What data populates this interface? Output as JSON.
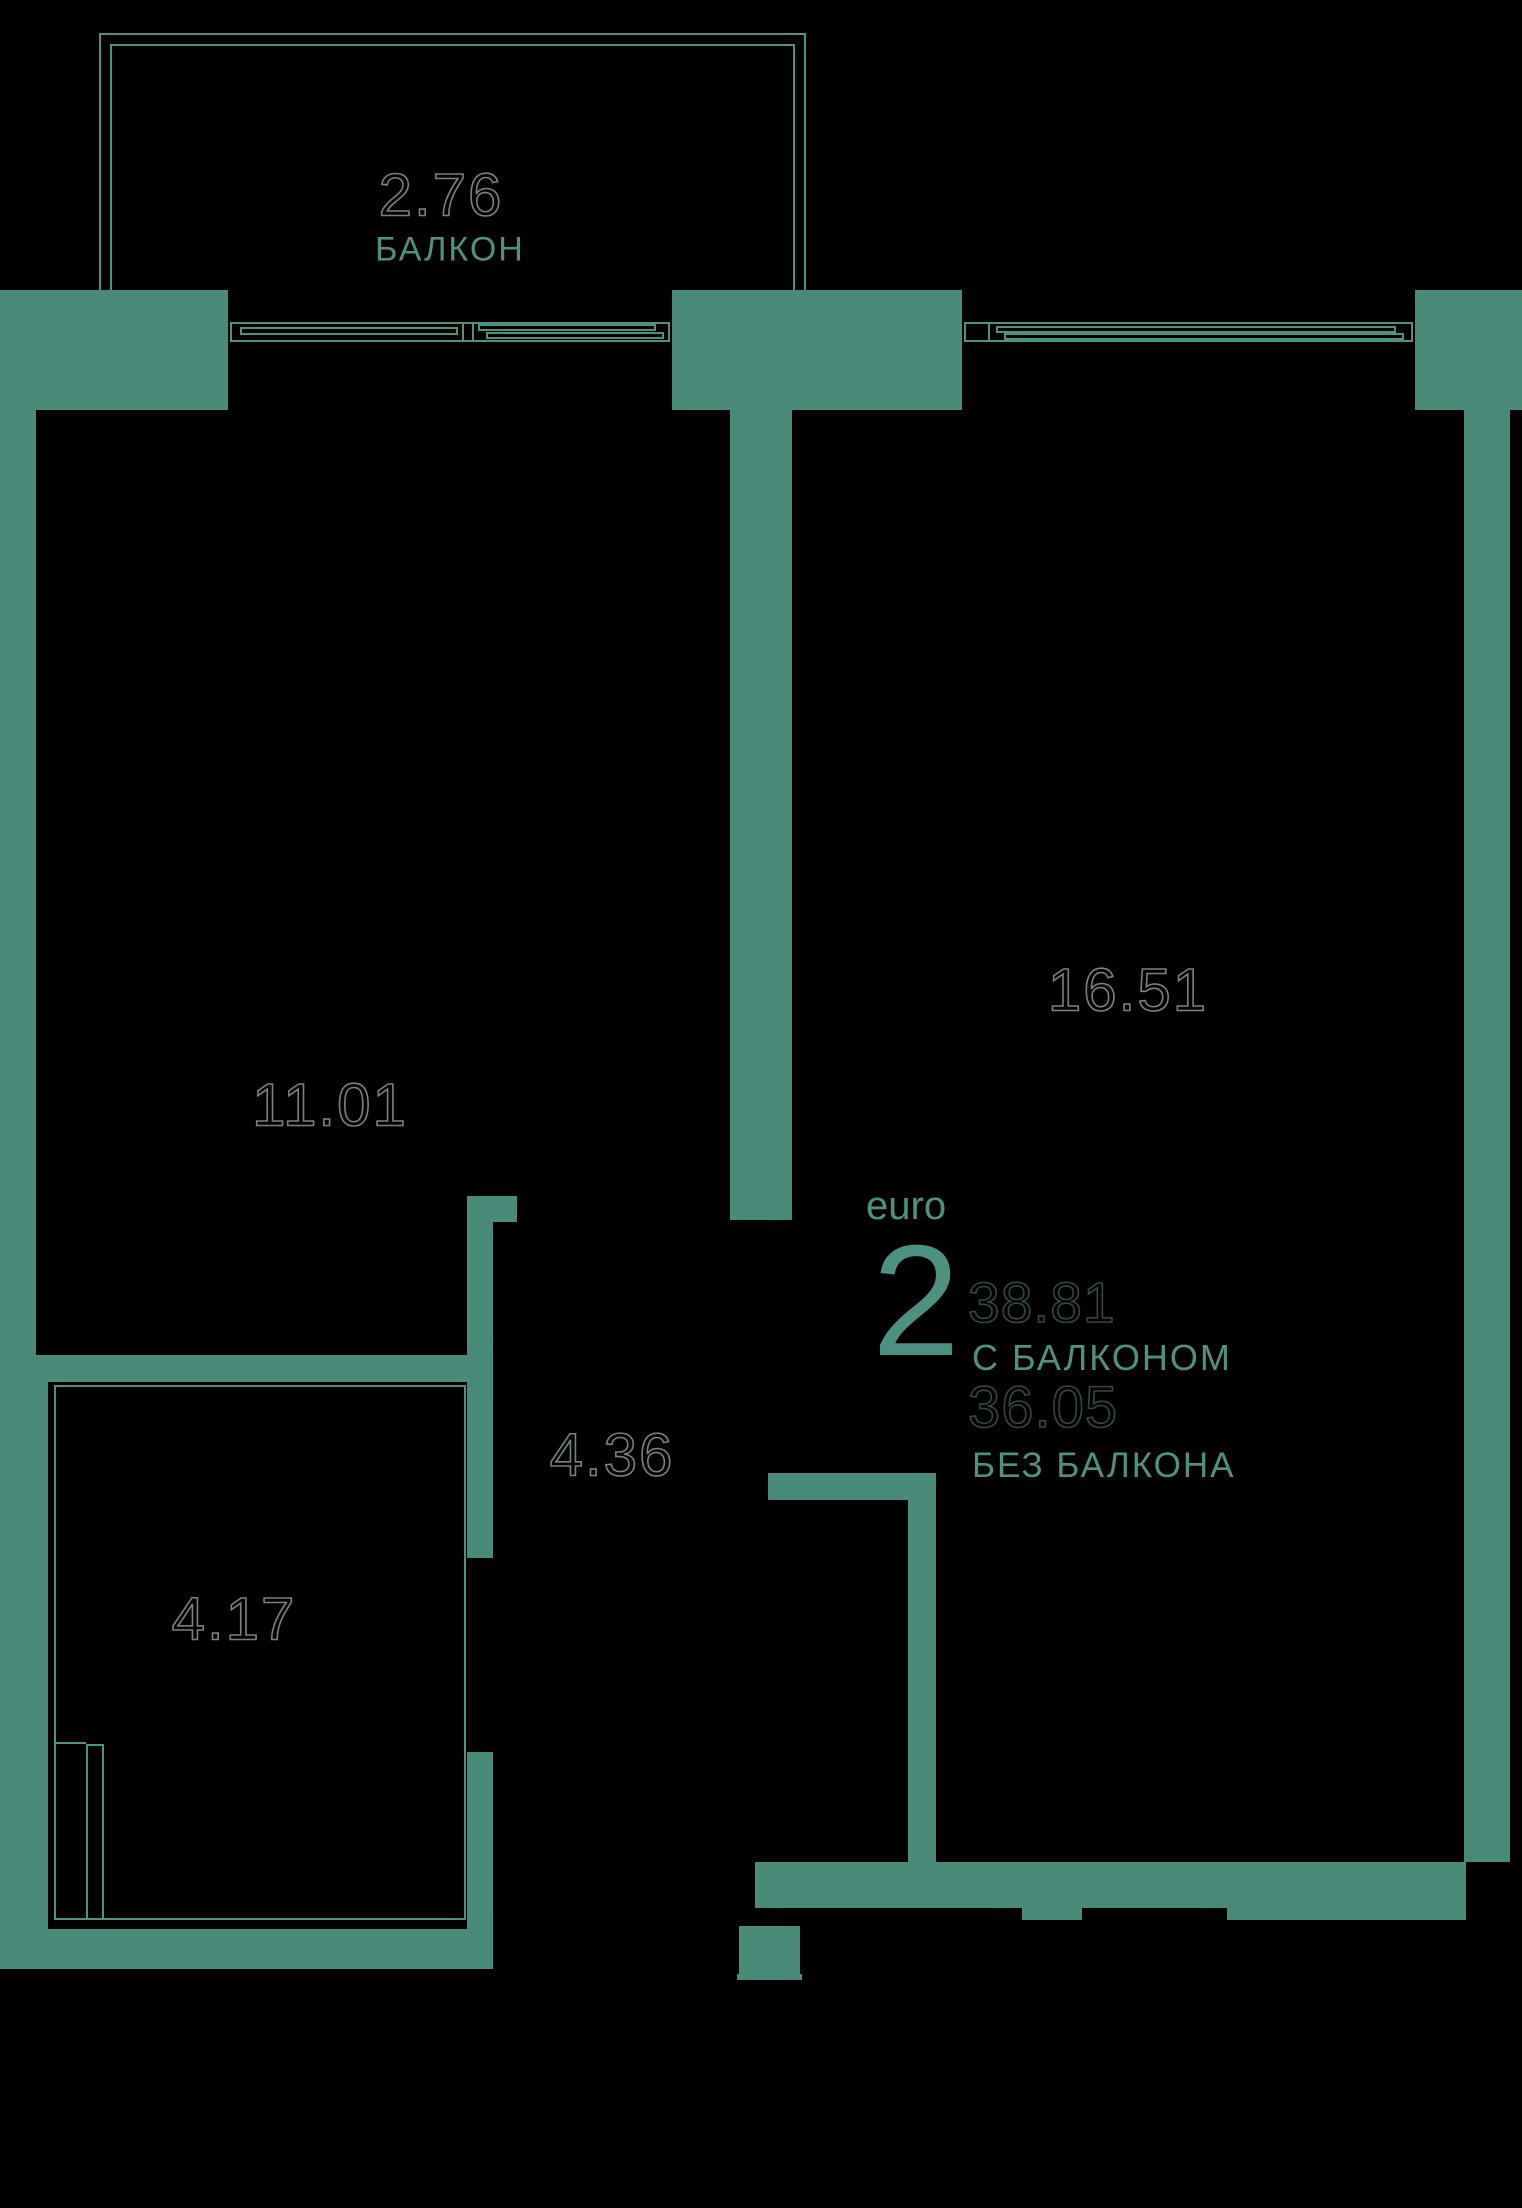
{
  "palette": {
    "background": "#000000",
    "wall": "#4a8a79",
    "line": "#4d9180",
    "teal_text": "#4d9180",
    "number_outline": "#77837d",
    "number_outline_dark": "#2f4a42"
  },
  "labels": {
    "balcony_area": "2.76",
    "balcony_name": "БАЛКОН",
    "room1_area": "11.01",
    "room2_area": "16.51",
    "corridor_area": "4.36",
    "bathroom_area": "4.17"
  },
  "info": {
    "type_label": "euro",
    "rooms_count": "2",
    "area_with_balcony": "38.81",
    "with_balcony_label": "С БАЛКОНОМ",
    "area_without_balcony": "36.05",
    "without_balcony_label": "БЕЗ БАЛКОНА"
  },
  "floorplan": {
    "walls": [
      {
        "name": "wall-top-left",
        "x": 0,
        "y": 290,
        "w": 228,
        "h": 120
      },
      {
        "name": "wall-top-middle",
        "x": 672,
        "y": 290,
        "w": 290,
        "h": 120
      },
      {
        "name": "wall-top-right",
        "x": 1415,
        "y": 290,
        "w": 107,
        "h": 120
      },
      {
        "name": "wall-left-upper",
        "x": 0,
        "y": 410,
        "w": 36,
        "h": 945
      },
      {
        "name": "wall-room-divider",
        "x": 730,
        "y": 410,
        "w": 62,
        "h": 810
      },
      {
        "name": "wall-room1-bathroom",
        "x": 0,
        "y": 1355,
        "w": 471,
        "h": 27
      },
      {
        "name": "wall-corridor-stub",
        "x": 467,
        "y": 1196,
        "w": 50,
        "h": 26
      },
      {
        "name": "wall-corridor-upper",
        "x": 467,
        "y": 1222,
        "w": 26,
        "h": 336
      },
      {
        "name": "wall-corridor-lower",
        "x": 467,
        "y": 1752,
        "w": 26,
        "h": 177
      },
      {
        "name": "wall-left-lower",
        "x": 0,
        "y": 1382,
        "w": 48,
        "h": 547
      },
      {
        "name": "wall-bottom-left",
        "x": 0,
        "y": 1929,
        "w": 493,
        "h": 40
      },
      {
        "name": "wall-hall-corner-h",
        "x": 768,
        "y": 1473,
        "w": 168,
        "h": 27
      },
      {
        "name": "wall-hall-corner-v",
        "x": 908,
        "y": 1500,
        "w": 28,
        "h": 362
      },
      {
        "name": "wall-entry-jamb",
        "x": 739,
        "y": 1926,
        "w": 61,
        "h": 54
      },
      {
        "name": "wall-entry-lip",
        "x": 737,
        "y": 1974,
        "w": 65,
        "h": 6
      },
      {
        "name": "wall-room2-bottom",
        "x": 755,
        "y": 1862,
        "w": 711,
        "h": 46
      },
      {
        "name": "wall-room2-bottom-step-left",
        "x": 1022,
        "y": 1908,
        "w": 60,
        "h": 12
      },
      {
        "name": "wall-room2-bottom-step-right",
        "x": 1227,
        "y": 1908,
        "w": 239,
        "h": 12
      },
      {
        "name": "wall-right",
        "x": 1464,
        "y": 410,
        "w": 46,
        "h": 1452
      }
    ],
    "lines": [
      {
        "name": "balcony-outer-left",
        "x": 99,
        "y": 33,
        "w": 2,
        "h": 257
      },
      {
        "name": "balcony-outer-top",
        "x": 99,
        "y": 33,
        "w": 707,
        "h": 2
      },
      {
        "name": "balcony-outer-right",
        "x": 804,
        "y": 33,
        "w": 2,
        "h": 257
      },
      {
        "name": "balcony-inner-left",
        "x": 110,
        "y": 44,
        "w": 2,
        "h": 246
      },
      {
        "name": "balcony-inner-top",
        "x": 110,
        "y": 44,
        "w": 685,
        "h": 2
      },
      {
        "name": "balcony-inner-right",
        "x": 793,
        "y": 44,
        "w": 2,
        "h": 246
      },
      {
        "name": "window1-frame-top",
        "x": 230,
        "y": 322,
        "w": 440,
        "h": 2
      },
      {
        "name": "window1-frame-bottom",
        "x": 230,
        "y": 340,
        "w": 440,
        "h": 2
      },
      {
        "name": "window1-frame-left",
        "x": 230,
        "y": 322,
        "w": 2,
        "h": 20
      },
      {
        "name": "window1-frame-right",
        "x": 668,
        "y": 322,
        "w": 2,
        "h": 20
      },
      {
        "name": "window1-divider-a",
        "x": 462,
        "y": 322,
        "w": 2,
        "h": 20
      },
      {
        "name": "window1-divider-b",
        "x": 472,
        "y": 322,
        "w": 2,
        "h": 20
      },
      {
        "name": "window1-sash1-top",
        "x": 240,
        "y": 327,
        "w": 218,
        "h": 2
      },
      {
        "name": "window1-sash1-bottom",
        "x": 240,
        "y": 333,
        "w": 218,
        "h": 2
      },
      {
        "name": "window1-sash1-left",
        "x": 240,
        "y": 327,
        "w": 2,
        "h": 8
      },
      {
        "name": "window1-sash1-right",
        "x": 456,
        "y": 327,
        "w": 2,
        "h": 8
      },
      {
        "name": "window1-sash2-top",
        "x": 478,
        "y": 324,
        "w": 178,
        "h": 2
      },
      {
        "name": "window1-sash2-bottom",
        "x": 478,
        "y": 329,
        "w": 178,
        "h": 2
      },
      {
        "name": "window1-sash2-left",
        "x": 478,
        "y": 324,
        "w": 2,
        "h": 7
      },
      {
        "name": "window1-sash2-right",
        "x": 654,
        "y": 324,
        "w": 2,
        "h": 7
      },
      {
        "name": "window1-sash3-top",
        "x": 486,
        "y": 332,
        "w": 178,
        "h": 2
      },
      {
        "name": "window1-sash3-bottom",
        "x": 486,
        "y": 337,
        "w": 178,
        "h": 2
      },
      {
        "name": "window1-sash3-left",
        "x": 486,
        "y": 332,
        "w": 2,
        "h": 7
      },
      {
        "name": "window1-sash3-right",
        "x": 662,
        "y": 332,
        "w": 2,
        "h": 7
      },
      {
        "name": "window2-frame-top",
        "x": 964,
        "y": 322,
        "w": 449,
        "h": 2
      },
      {
        "name": "window2-frame-bottom",
        "x": 964,
        "y": 340,
        "w": 449,
        "h": 2
      },
      {
        "name": "window2-frame-left",
        "x": 964,
        "y": 322,
        "w": 2,
        "h": 20
      },
      {
        "name": "window2-frame-right",
        "x": 1411,
        "y": 322,
        "w": 2,
        "h": 20
      },
      {
        "name": "window2-divider",
        "x": 988,
        "y": 322,
        "w": 2,
        "h": 20
      },
      {
        "name": "window2-sash1-top",
        "x": 996,
        "y": 326,
        "w": 400,
        "h": 2
      },
      {
        "name": "window2-sash1-bottom",
        "x": 996,
        "y": 331,
        "w": 400,
        "h": 2
      },
      {
        "name": "window2-sash1-left",
        "x": 996,
        "y": 326,
        "w": 2,
        "h": 7
      },
      {
        "name": "window2-sash1-right",
        "x": 1394,
        "y": 326,
        "w": 2,
        "h": 7
      },
      {
        "name": "window2-sash2-top",
        "x": 1004,
        "y": 333,
        "w": 400,
        "h": 2
      },
      {
        "name": "window2-sash2-bottom",
        "x": 1004,
        "y": 338,
        "w": 400,
        "h": 2
      },
      {
        "name": "window2-sash2-left",
        "x": 1004,
        "y": 333,
        "w": 2,
        "h": 7
      },
      {
        "name": "window2-sash2-right",
        "x": 1402,
        "y": 333,
        "w": 2,
        "h": 7
      },
      {
        "name": "bathroom-outline-top",
        "x": 54,
        "y": 1385,
        "w": 412,
        "h": 2
      },
      {
        "name": "bathroom-outline-left",
        "x": 54,
        "y": 1385,
        "w": 2,
        "h": 535
      },
      {
        "name": "bathroom-outline-bottom",
        "x": 54,
        "y": 1918,
        "w": 412,
        "h": 2
      },
      {
        "name": "bathroom-outline-right",
        "x": 464,
        "y": 1385,
        "w": 2,
        "h": 535
      },
      {
        "name": "shaft-left",
        "x": 86,
        "y": 1744,
        "w": 2,
        "h": 176
      },
      {
        "name": "shaft-right",
        "x": 102,
        "y": 1744,
        "w": 2,
        "h": 176
      },
      {
        "name": "shaft-top",
        "x": 86,
        "y": 1744,
        "w": 18,
        "h": 2
      },
      {
        "name": "shaft-connector",
        "x": 56,
        "y": 1742,
        "w": 30,
        "h": 2
      }
    ]
  }
}
